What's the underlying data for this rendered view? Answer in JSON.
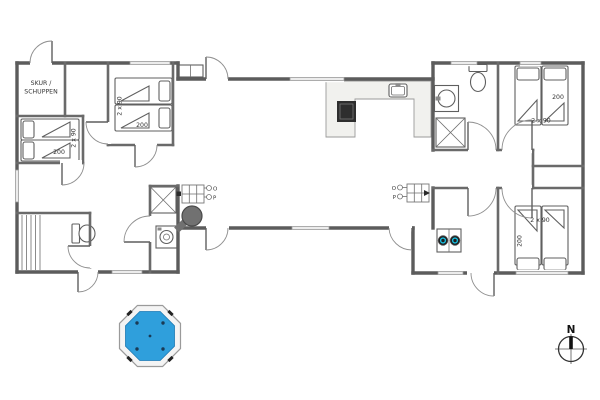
{
  "page": {
    "type": "architectural floor plan of holiday house with hot tub and compass"
  },
  "labels": {
    "shed_line1": "SKUR /",
    "shed_line2": "SCHUPPEN",
    "north": "N",
    "o": "O",
    "p": "P"
  },
  "bedrooms": {
    "left_lower": {
      "length": "200",
      "width": "2 x 90"
    },
    "left_upper": {
      "length": "200",
      "width": "2 x 90"
    },
    "right_top": {
      "length": "200",
      "width": "2 x 90"
    },
    "right_bottom": {
      "length": "200",
      "width": "2 x 90"
    }
  },
  "colors": {
    "wall_exterior": "#5c5c5c",
    "wall_interior": "#6a6a6a",
    "hot_tub_water": "#2f9fdc",
    "hot_tub_rim": "#f4f4f4",
    "cooktop": "#2e2e2e",
    "wood_stove": "#717171",
    "appliance_accent": "#18bfe0"
  }
}
